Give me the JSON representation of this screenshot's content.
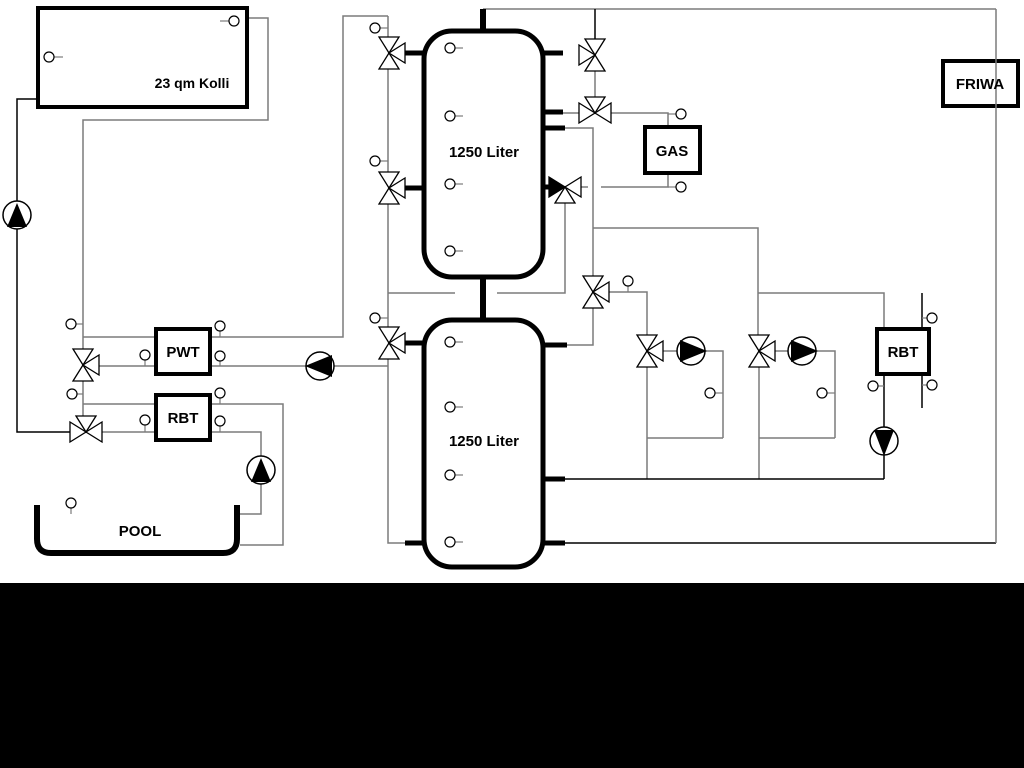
{
  "diagram": {
    "labels": {
      "collector": "23 qm Kolli",
      "tank1": "1250 Liter",
      "tank2": "1250 Liter",
      "pwt": "PWT",
      "rbt_left": "RBT",
      "gas": "GAS",
      "friwa": "FRIWA",
      "rbt_right": "RBT",
      "pool": "POOL"
    },
    "colors": {
      "pipe_gray": "#7b7b7b",
      "pipe_black": "#000000",
      "component_outline": "#000000",
      "background": "#ffffff",
      "bottom_bar": "#000000"
    }
  }
}
